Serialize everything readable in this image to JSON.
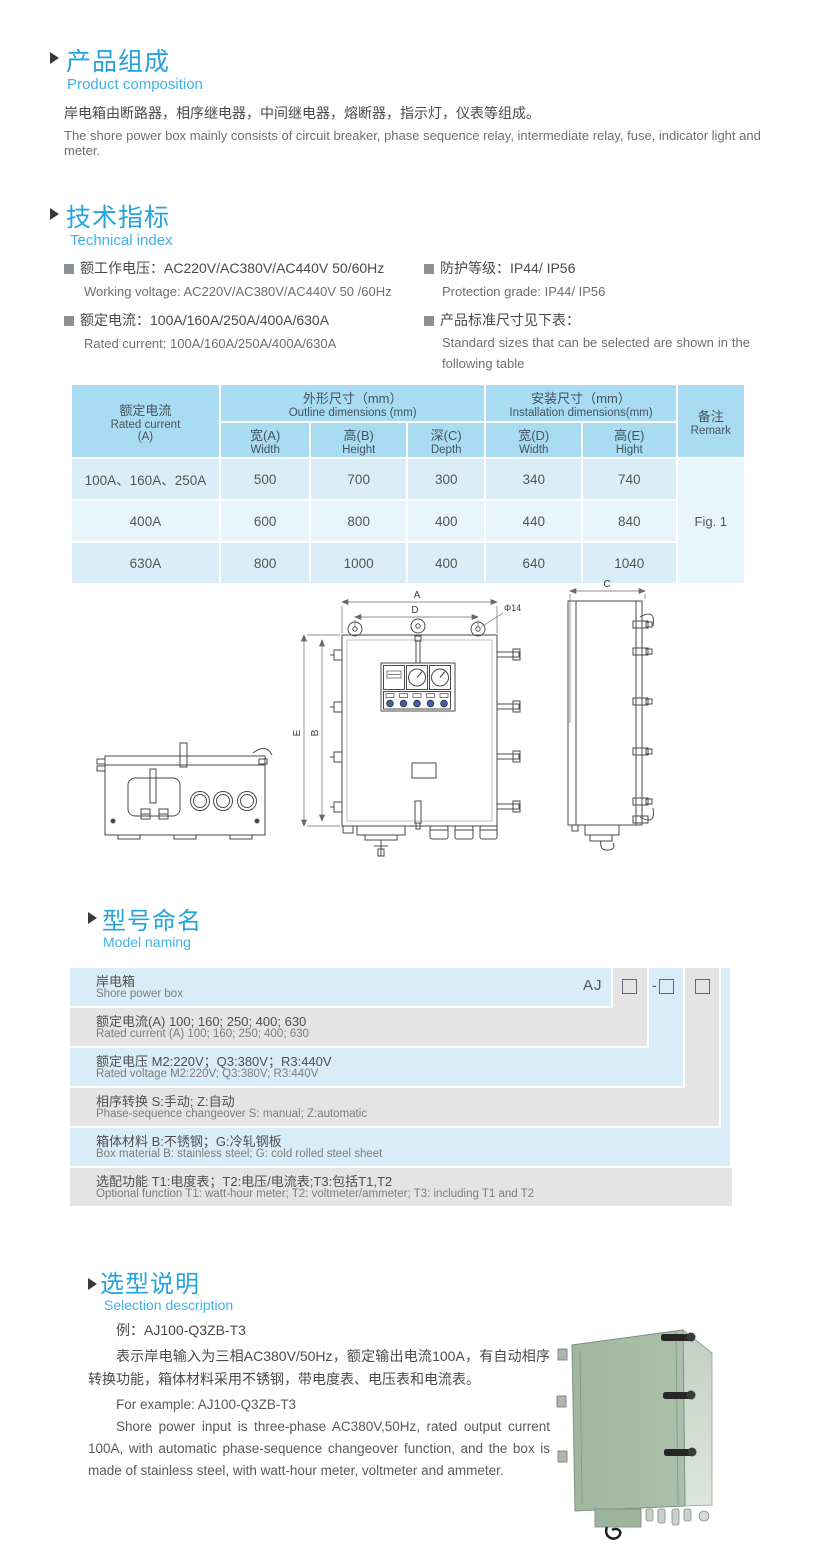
{
  "colors": {
    "accent_blue": "#25a3dd",
    "table_header_blue": "#a9dbf2",
    "row_blue_dark": "#d9eef9",
    "row_blue_light": "#e9f5fc",
    "model_blue": "#d9edf8",
    "model_gray": "#e4e4e4",
    "cabinet_green": "#a5bba6"
  },
  "composition": {
    "title_zh": "产品组成",
    "title_en": "Product  composition",
    "body_zh": "岸电箱由断路器，相序继电器，中间继电器，熔断器，指示灯，仪表等组成。",
    "body_en": "The shore power box mainly consists of circuit breaker, phase sequence relay, intermediate relay, fuse, indicator light and meter."
  },
  "technical": {
    "title_zh": "技术指标",
    "title_en": "Technical index",
    "specs": [
      {
        "zh": "额工作电压：AC220V/AC380V/AC440V  50/60Hz",
        "en": "Working voltage: AC220V/AC380V/AC440V 50 /60Hz"
      },
      {
        "zh": "额定电流：100A/160A/250A/400A/630A",
        "en": "Rated current: 100A/160A/250A/400A/630A"
      },
      {
        "zh": "防护等级：IP44/ IP56",
        "en": "Protection grade: IP44/ IP56"
      },
      {
        "zh": "产品标准尺寸见下表：",
        "en": "Standard sizes that can be selected are shown in the following table"
      }
    ]
  },
  "size_table": {
    "col_current": {
      "zh": "额定电流",
      "en": "Rated current",
      "unit": "(A)"
    },
    "group_outline": {
      "zh": "外形尺寸（mm）",
      "en": "Outline dimensions (mm)"
    },
    "group_install": {
      "zh": "安装尺寸（mm）",
      "en": "Installation dimensions(mm)"
    },
    "sub": [
      {
        "zh": "宽(A)",
        "en": "Width"
      },
      {
        "zh": "高(B)",
        "en": "Height"
      },
      {
        "zh": "深(C)",
        "en": "Depth"
      },
      {
        "zh": "宽(D)",
        "en": "Width"
      },
      {
        "zh": "高(E)",
        "en": "Hight"
      }
    ],
    "col_remark": {
      "zh": "备注",
      "en": "Remark"
    },
    "rows": [
      {
        "current": "100A、160A、250A",
        "values": [
          "500",
          "700",
          "300",
          "340",
          "740"
        ]
      },
      {
        "current": "400A",
        "values": [
          "600",
          "800",
          "400",
          "440",
          "840"
        ]
      },
      {
        "current": "630A",
        "values": [
          "800",
          "1000",
          "400",
          "640",
          "1040"
        ]
      }
    ],
    "remark_value": "Fig. 1"
  },
  "drawing": {
    "dim_a": "A",
    "dim_b": "B",
    "dim_c": "C",
    "dim_d": "D",
    "dim_e": "E",
    "hole": "Φ14"
  },
  "model_naming": {
    "title_zh": "型号命名",
    "title_en": "Model naming",
    "prefix": "AJ",
    "rows": [
      {
        "zh": "岸电箱",
        "en": "Shore power box"
      },
      {
        "zh": "额定电流(A)  100; 160; 250; 400; 630",
        "en": "Rated current (A) 100; 160; 250; 400; 630"
      },
      {
        "zh": "额定电压   M2:220V；Q3:380V；R3:440V",
        "en": "Rated voltage  M2:220V;  Q3:380V;  R3:440V"
      },
      {
        "zh": "相序转换  S:手动; Z:自动",
        "en": "Phase-sequence changeover  S: manual;  Z:automatic"
      },
      {
        "zh": "箱体材料    B:不锈钢；G:冷轧钢板",
        "en": "Box material   B: stainless steel; G: cold rolled steel sheet"
      },
      {
        "zh": "选配功能     T1:电度表；T2:电压/电流表;T3:包括T1,T2",
        "en": "Optional function  T1: watt-hour meter; T2: voltmeter/ammeter; T3: including T1 and T2"
      }
    ]
  },
  "selection": {
    "title_zh": "选型说明",
    "title_en": "Selection description",
    "example_zh": "例：AJ100-Q3ZB-T3",
    "body_zh": "表示岸电输入为三相AC380V/50Hz，额定输出电流100A，有自动相序转换功能，箱体材料采用不锈钢，带电度表、电压表和电流表。",
    "example_en": "For example: AJ100-Q3ZB-T3",
    "body_en": "Shore power input is three-phase AC380V,50Hz, rated output current 100A, with automatic phase-sequence changeover function, and the box is made of stainless steel, with watt-hour meter, voltmeter and ammeter."
  }
}
